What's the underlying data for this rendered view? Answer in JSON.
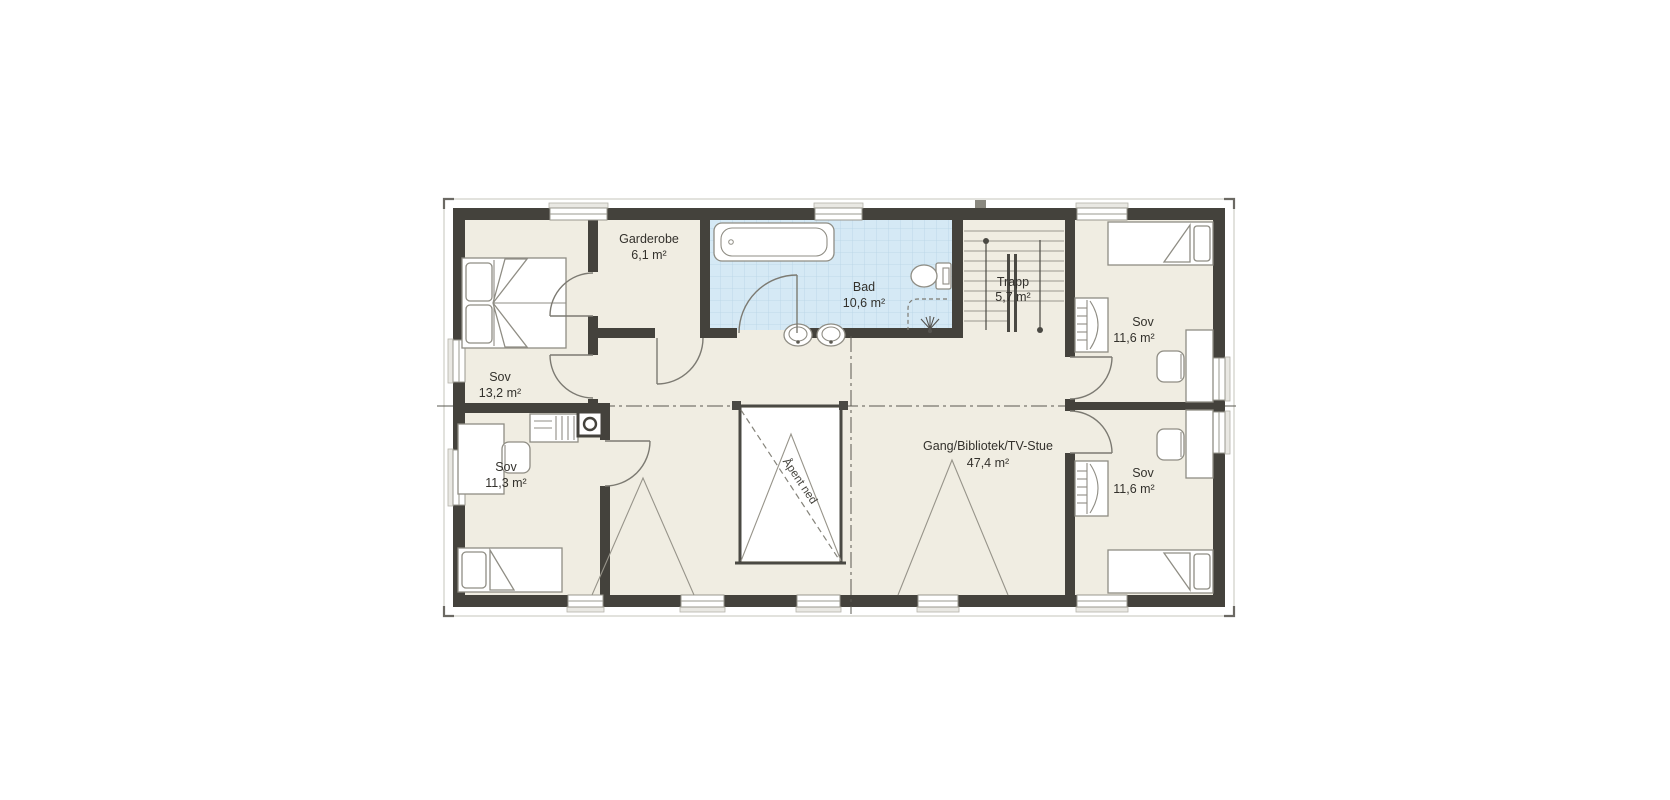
{
  "page": {
    "background": "#ffffff"
  },
  "floor_plan": {
    "rooms": {
      "sov_upper_left": {
        "name": "Sov",
        "area": "13,2 m²"
      },
      "sov_lower_left": {
        "name": "Sov",
        "area": "11,3 m²"
      },
      "garderobe": {
        "name": "Garderobe",
        "area": "6,1 m²"
      },
      "bad": {
        "name": "Bad",
        "area": "10,6 m²"
      },
      "trapp": {
        "name": "Trapp",
        "area": "5,7 m²"
      },
      "sov_upper_right": {
        "name": "Sov",
        "area": "11,6 m²"
      },
      "sov_lower_right": {
        "name": "Sov",
        "area": "11,6 m²"
      },
      "gang": {
        "name": "Gang/Bibliotek/TV-Stue",
        "area": "47,4 m²"
      }
    },
    "annotations": {
      "open_below": "Åpent ned"
    },
    "colors": {
      "wall": "#44423c",
      "floor": "#f0ede2",
      "bath_floor": "#d5e9f5",
      "bath_grid": "#b7d4e6",
      "void": "#ffffff",
      "furniture_line": "#8f8d84",
      "label_text": "#33312c"
    }
  }
}
